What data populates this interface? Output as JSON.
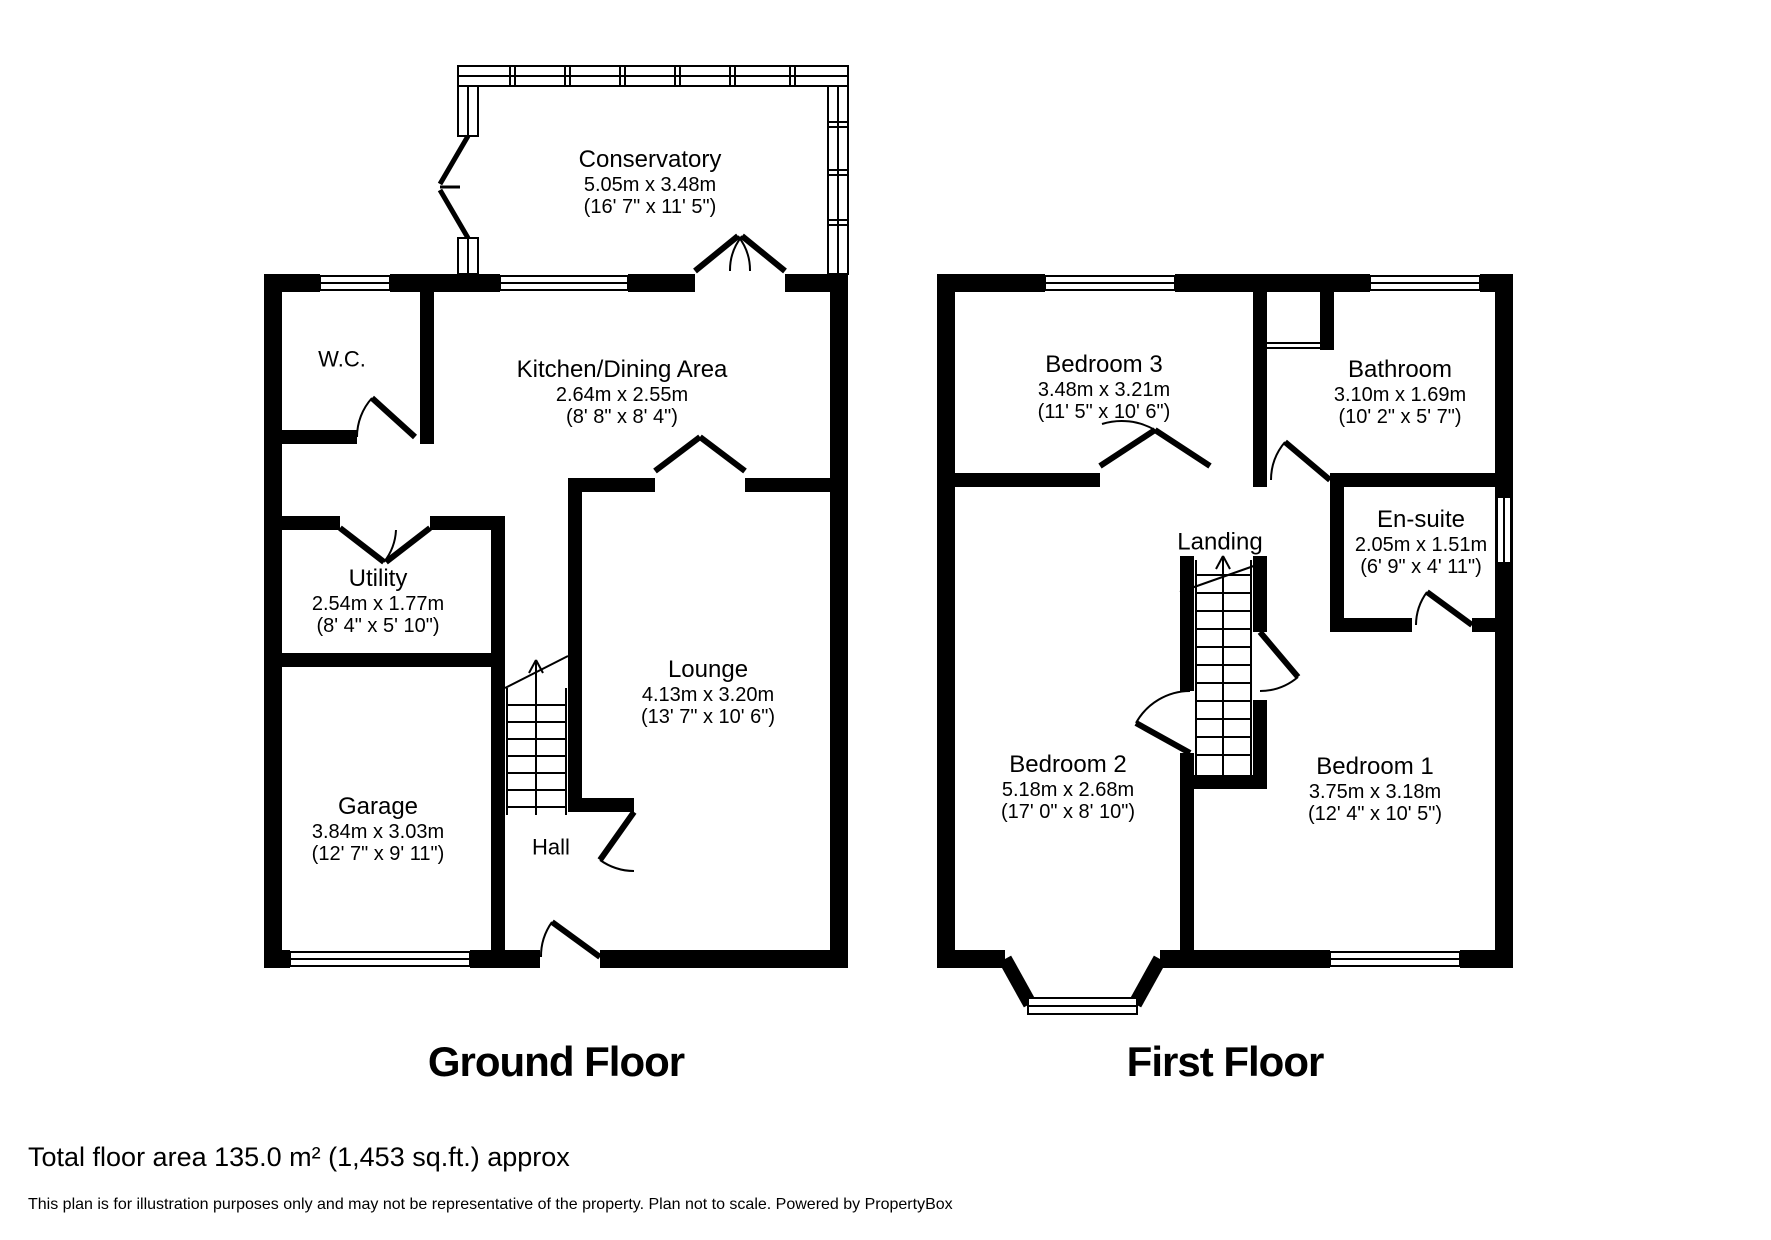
{
  "colors": {
    "wall": "#000000",
    "background": "#ffffff",
    "text": "#000000"
  },
  "ground_floor": {
    "title": "Ground Floor",
    "rooms": {
      "conservatory": {
        "name": "Conservatory",
        "metric": "5.05m x 3.48m",
        "imperial": "(16' 7\" x 11' 5\")"
      },
      "wc": {
        "name": "W.C."
      },
      "kitchen": {
        "name": "Kitchen/Dining Area",
        "metric": "2.64m x 2.55m",
        "imperial": "(8' 8\" x 8' 4\")"
      },
      "utility": {
        "name": "Utility",
        "metric": "2.54m x 1.77m",
        "imperial": "(8' 4\" x 5' 10\")"
      },
      "lounge": {
        "name": "Lounge",
        "metric": "4.13m x 3.20m",
        "imperial": "(13' 7\" x 10' 6\")"
      },
      "garage": {
        "name": "Garage",
        "metric": "3.84m x 3.03m",
        "imperial": "(12' 7\" x 9' 11\")"
      },
      "hall": {
        "name": "Hall"
      }
    }
  },
  "first_floor": {
    "title": "First Floor",
    "rooms": {
      "bedroom3": {
        "name": "Bedroom 3",
        "metric": "3.48m x 3.21m",
        "imperial": "(11' 5\" x 10' 6\")"
      },
      "bathroom": {
        "name": "Bathroom",
        "metric": "3.10m x 1.69m",
        "imperial": "(10' 2\" x 5' 7\")"
      },
      "landing": {
        "name": "Landing"
      },
      "ensuite": {
        "name": "En-suite",
        "metric": "2.05m x 1.51m",
        "imperial": "(6' 9\" x 4' 11\")"
      },
      "bedroom2": {
        "name": "Bedroom 2",
        "metric": "5.18m x 2.68m",
        "imperial": "(17' 0\" x 8' 10\")"
      },
      "bedroom1": {
        "name": "Bedroom 1",
        "metric": "3.75m x 3.18m",
        "imperial": "(12' 4\" x 10' 5\")"
      }
    }
  },
  "footer": {
    "total_area": "Total floor area 135.0 m² (1,453 sq.ft.) approx",
    "disclaimer": "This plan is for illustration purposes only and may not be representative of the property. Plan not to scale. Powered by PropertyBox"
  }
}
